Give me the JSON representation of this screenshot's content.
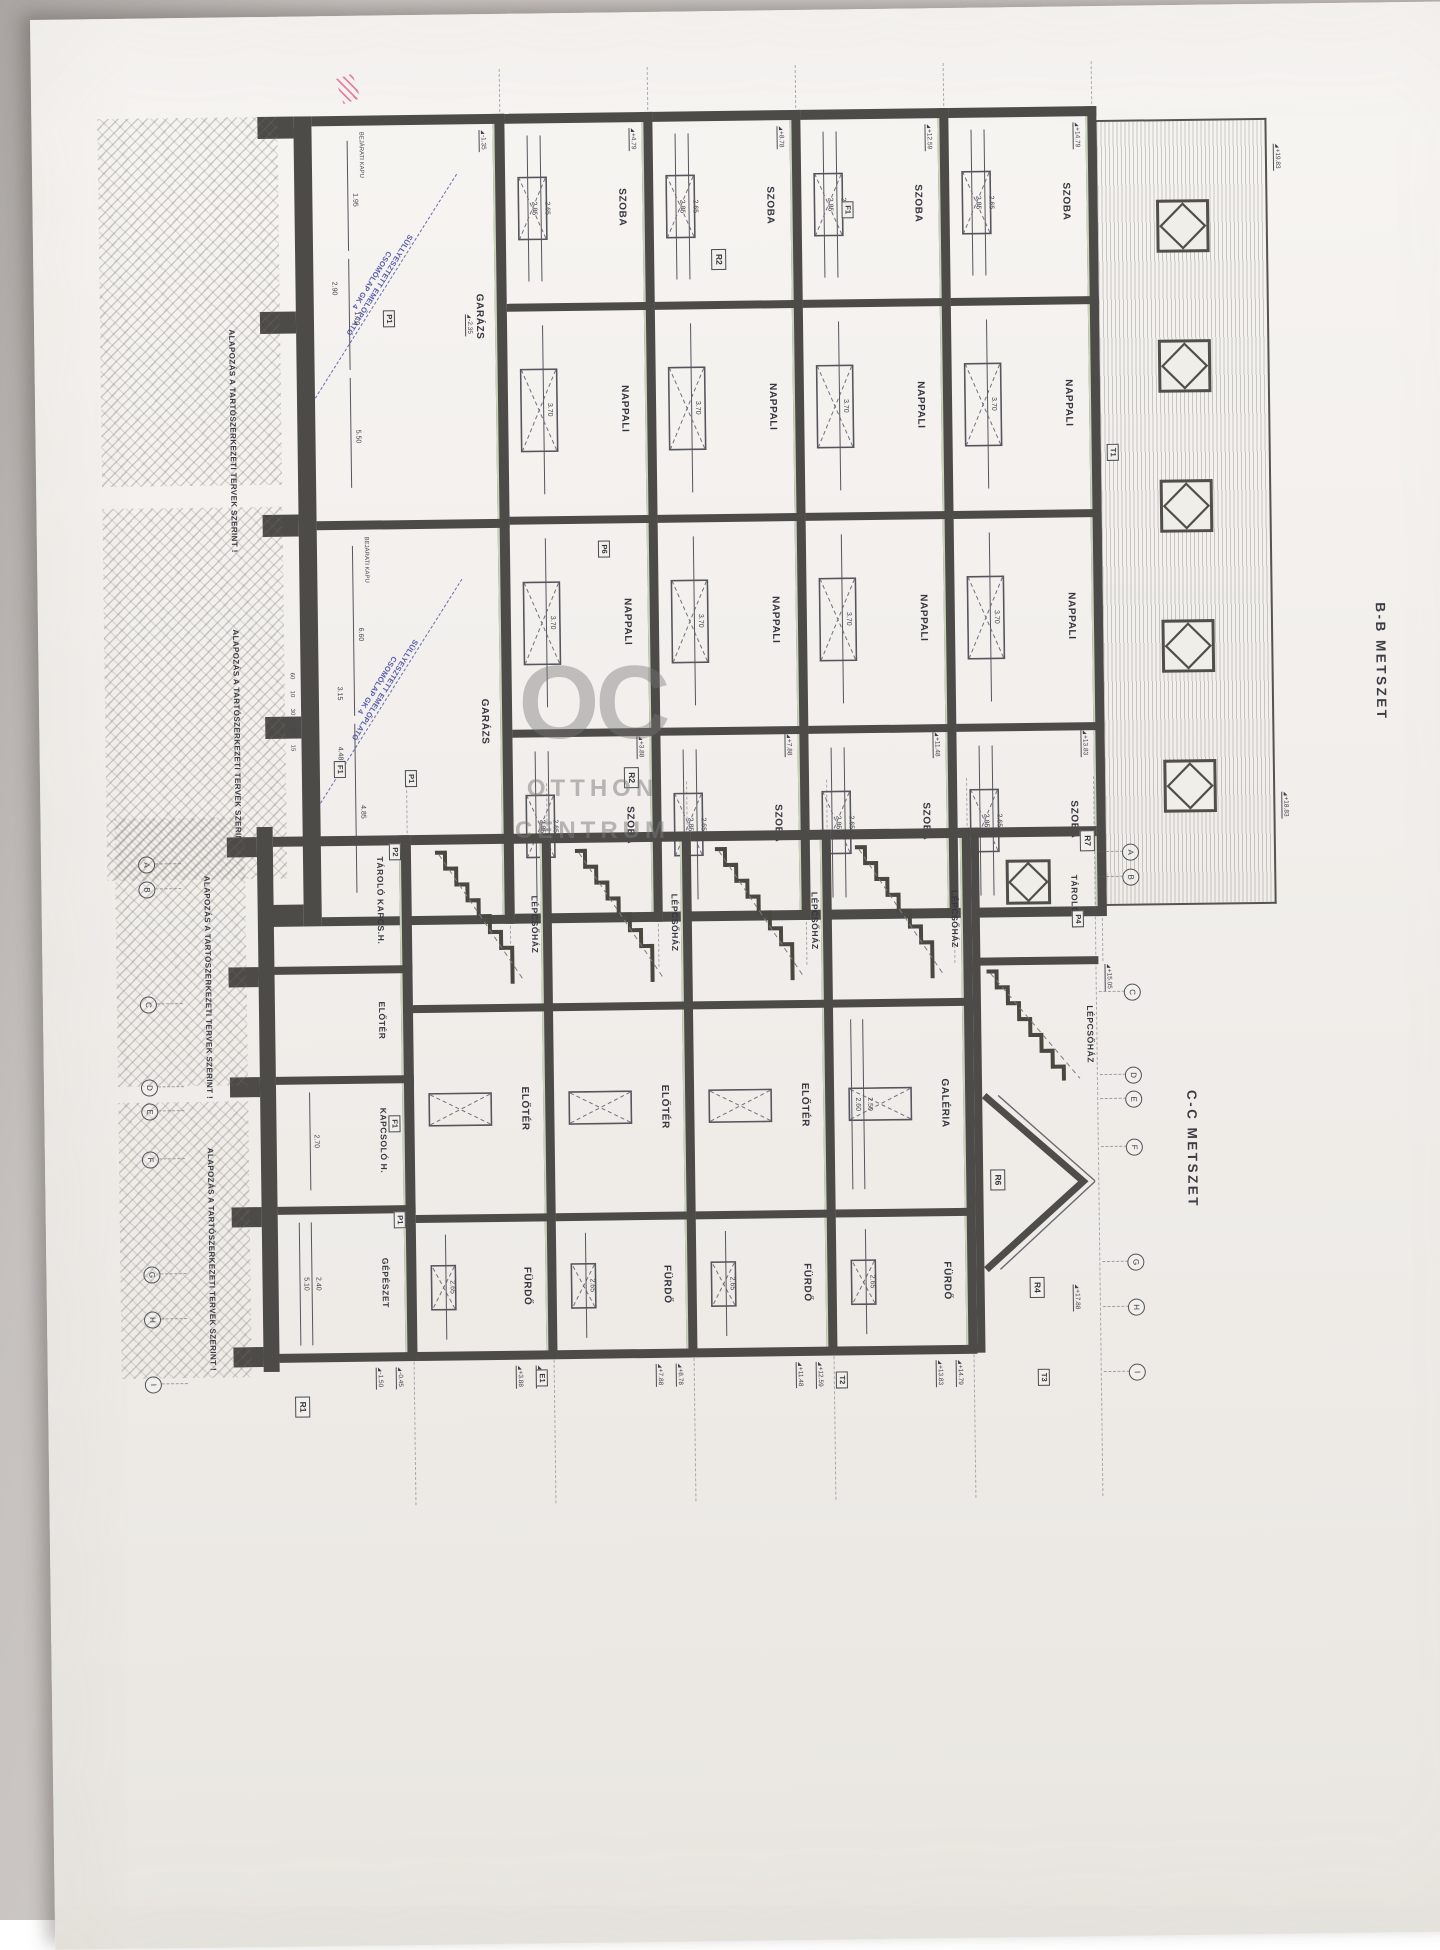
{
  "watermark": {
    "logo": "OC",
    "line1": "OTTHON",
    "line2": "CENTRUM"
  },
  "pink_mark": "pen scribble",
  "sections": [
    {
      "id": "bb",
      "title": "B-B METSZET",
      "roof": {
        "window_count": 5,
        "elevations": [
          "+19.83",
          "+18.83"
        ],
        "marker": "T1"
      },
      "storeys": [
        {
          "cells": [
            {
              "label": "SZOBA",
              "dims": [
                "2.65",
                "2.85"
              ]
            },
            {
              "label": "NAPPALI",
              "dims": [
                "3.70"
              ]
            },
            {
              "label": "NAPPALI",
              "dims": [
                "3.70"
              ]
            },
            {
              "label": "SZOBA",
              "dims": [
                "2.65",
                "2.85"
              ]
            }
          ],
          "elevations": [
            "+14.79",
            "+13.83"
          ]
        },
        {
          "cells": [
            {
              "label": "SZOBA",
              "dims": [
                "2.65",
                "2.85"
              ]
            },
            {
              "label": "NAPPALI",
              "dims": [
                "3.70"
              ]
            },
            {
              "label": "NAPPALI",
              "dims": [
                "3.70"
              ]
            },
            {
              "label": "SZOBA",
              "dims": [
                "2.65",
                "2.85"
              ]
            }
          ],
          "elevations": [
            "+12.59",
            "+11.48"
          ]
        },
        {
          "cells": [
            {
              "label": "SZOBA",
              "dims": [
                "2.65",
                "2.85"
              ]
            },
            {
              "label": "NAPPALI",
              "dims": [
                "3.70"
              ]
            },
            {
              "label": "NAPPALI",
              "dims": [
                "3.70"
              ]
            },
            {
              "label": "SZOBA",
              "dims": [
                "2.65",
                "2.85"
              ]
            }
          ],
          "elevations": [
            "+8.78",
            "+7.88"
          ]
        },
        {
          "cells": [
            {
              "label": "SZOBA",
              "dims": [
                "2.65",
                "2.85"
              ]
            },
            {
              "label": "NAPPALI",
              "dims": [
                "3.70"
              ]
            },
            {
              "label": "NAPPALI",
              "dims": [
                "3.70"
              ]
            },
            {
              "label": "SZOBA",
              "dims": [
                "2.65",
                "2.85"
              ]
            }
          ],
          "elevations": [
            "+4.79",
            "+3.88"
          ]
        }
      ],
      "garage": {
        "cells": [
          {
            "label": "GARÁZS",
            "dims": [
              "1.95",
              "1.70",
              "5.50"
            ],
            "dims2": [
              "2.90"
            ],
            "door_label": "BEJÁRATI KAPU"
          },
          {
            "label": "GARÁZS",
            "dims": [
              "6.60",
              "4.85"
            ],
            "dims2": [
              "3.15",
              "4.48"
            ],
            "door_label": "BEJÁRATI KAPU"
          }
        ],
        "platform_note_line1": "SÜLLYESZTETT EMELŐPLATÓ",
        "platform_note_line2": "CSOMÓLAP GK 4",
        "elevations": [
          "-1.35",
          "-2.35"
        ]
      },
      "wall_ticks": [
        "60",
        "10",
        "30",
        "20",
        "15"
      ],
      "markers": [
        "P1",
        "P1",
        "P6",
        "R2",
        "R2",
        "F1",
        "F1",
        "T1"
      ],
      "notes": [
        "ALAPOZÁS A TARTÓSZERKEZETI TERVEK SZERINT !",
        "ALAPOZÁS A TARTÓSZERKEZETI TERVEK SZERINT !"
      ]
    },
    {
      "id": "cc",
      "title": "C-C METSZET",
      "grid_letters": [
        "A",
        "B",
        "C",
        "D",
        "E",
        "F",
        "G",
        "H",
        "I"
      ],
      "roof": {
        "cells": [
          {
            "label": "TÁROLÓ"
          },
          {
            "label": "LÉPCSŐHÁZ"
          }
        ],
        "elevations": [
          "+17.88",
          "+15.05"
        ],
        "markers": [
          "R7",
          "P4",
          "R4",
          "R6",
          "T3"
        ]
      },
      "storeys": [
        {
          "cells": [
            {
              "label": "LÉPCSŐHÁZ"
            },
            {
              "label": "GALÉRIA",
              "dims": [
                "2.50",
                "2.60"
              ]
            },
            {
              "label": "FÜRDŐ",
              "dims": [
                "2.65"
              ]
            }
          ],
          "elevations": [
            "+14.79",
            "+13.83"
          ]
        },
        {
          "cells": [
            {
              "label": "LÉPCSŐHÁZ"
            },
            {
              "label": "ELŐTÉR"
            },
            {
              "label": "FÜRDŐ",
              "dims": [
                "2.65"
              ]
            }
          ],
          "elevations": [
            "+12.59",
            "+11.48"
          ]
        },
        {
          "cells": [
            {
              "label": "LÉPCSŐHÁZ"
            },
            {
              "label": "ELŐTÉR"
            },
            {
              "label": "FÜRDŐ",
              "dims": [
                "2.65"
              ]
            }
          ],
          "elevations": [
            "+8.78",
            "+7.88"
          ]
        },
        {
          "cells": [
            {
              "label": "LÉPCSŐHÁZ"
            },
            {
              "label": "ELŐTÉR"
            },
            {
              "label": "FÜRDŐ",
              "dims": [
                "2.65"
              ]
            }
          ],
          "elevations": [
            "+4.79",
            "+3.88"
          ]
        }
      ],
      "basement": {
        "cells": [
          {
            "label": "TÁROLÓ KAPCS.H."
          },
          {
            "label": "ELŐTÉR"
          },
          {
            "label": "KAPCSOLÓ H.",
            "dims": [
              "2.70"
            ]
          },
          {
            "label": "GÉPÉSZET",
            "dims": [
              "2.40",
              "5.10"
            ]
          }
        ],
        "elevations": [
          "-0.45",
          "-1.50"
        ]
      },
      "markers": [
        "R7",
        "P4",
        "R4",
        "R6",
        "T3",
        "T2",
        "E1",
        "P2",
        "P1",
        "F1",
        "R1"
      ],
      "notes": [
        "ALAPOZÁS A TARTÓSZERKEZETI TERVEK SZERINT !",
        "ALAPOZÁS A TARTÓSZERKEZETI TERVEK SZERINT !"
      ]
    }
  ]
}
